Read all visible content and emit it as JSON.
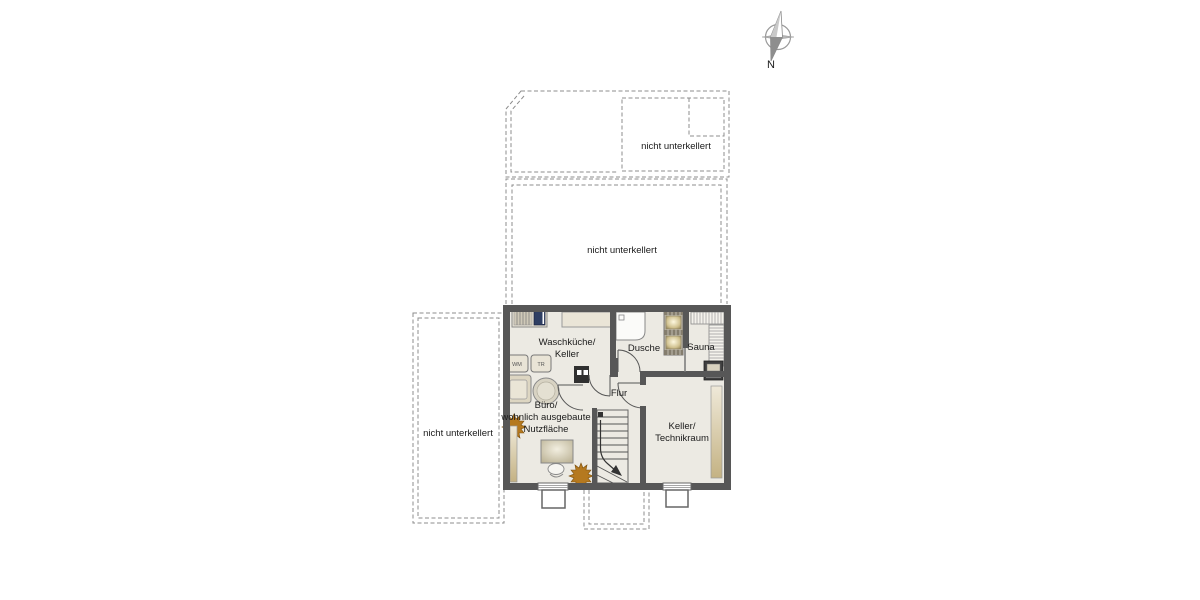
{
  "plan_title": "Kellergeschoss Grundriss",
  "compass": {
    "label": "N"
  },
  "regions": {
    "top": {
      "label": "nicht unterkellert"
    },
    "middle": {
      "label": "nicht unterkellert"
    },
    "left": {
      "label": "nicht unterkellert"
    }
  },
  "rooms": {
    "waschkueche": {
      "line1": "Waschküche/",
      "line2": "Keller"
    },
    "dusche": {
      "label": "Dusche"
    },
    "sauna": {
      "label": "Sauna"
    },
    "flur": {
      "label": "Flur"
    },
    "buero": {
      "line1": "Büro/",
      "line2": "wohnlich ausgebaute",
      "line3": "Nutzfläche"
    },
    "technikraum": {
      "line1": "Keller/",
      "line2": "Technikraum"
    }
  },
  "appliances": {
    "washer": "WM",
    "dryer": "TR"
  },
  "colors": {
    "wall": "#575757",
    "floor": "#eceae3",
    "dashed_outline": "#8c8c8c",
    "furniture_fill": "#ddd6c2",
    "counter_fill": "#eae5d7",
    "bench_fill": "#f4f2ec",
    "plant": "#b5791f",
    "appliance_navy": "#2e3e63",
    "text": "#1a1a1a"
  }
}
